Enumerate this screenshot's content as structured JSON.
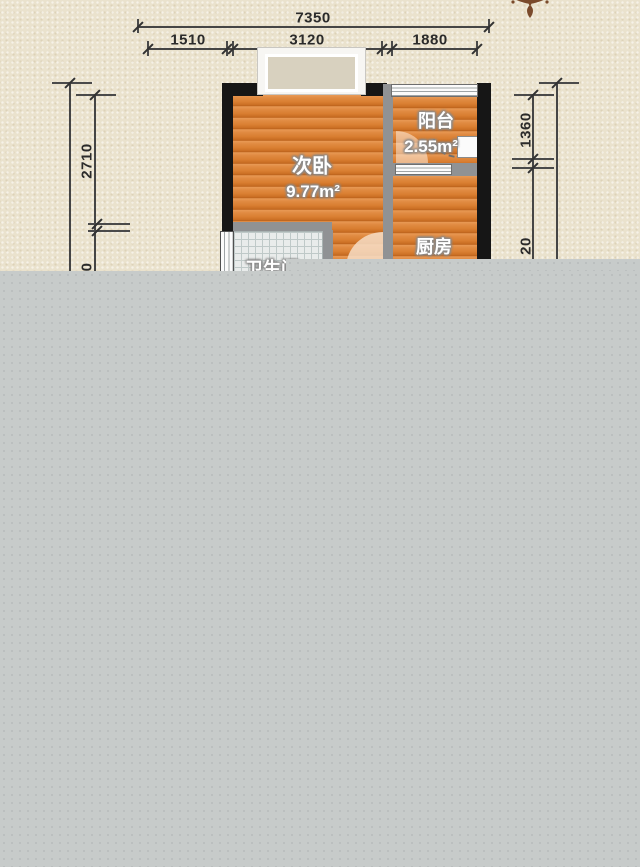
{
  "title": "apartment-floor-plan",
  "ornament": {
    "name": "floral-corner-ornament",
    "color": "#7a4a2b"
  },
  "dimensions": {
    "top_total": "7350",
    "top_segments": [
      "1510",
      "3120",
      "1880"
    ],
    "left": {
      "upper": "2710",
      "lower_visible_fragment": "0"
    },
    "right": {
      "upper": "1360",
      "lower_visible_fragment": "20"
    }
  },
  "rooms": {
    "bedroom": {
      "name": "次卧",
      "area": "9.77m²"
    },
    "balcony": {
      "name": "阳台",
      "area": "2.55m²"
    },
    "kitchen": {
      "name": "厨房"
    },
    "bathroom": {
      "name": "卫生间"
    }
  },
  "colors": {
    "background": "#eae2cd",
    "wood_floor": "#dd8a41",
    "wall_black": "#161616",
    "wall_gray": "#909294",
    "tile": "#e9eceb",
    "overlay_gray": "#c7cbca",
    "dimension_text": "#2b2b2b",
    "ornament_brown": "#7a4a2b"
  }
}
